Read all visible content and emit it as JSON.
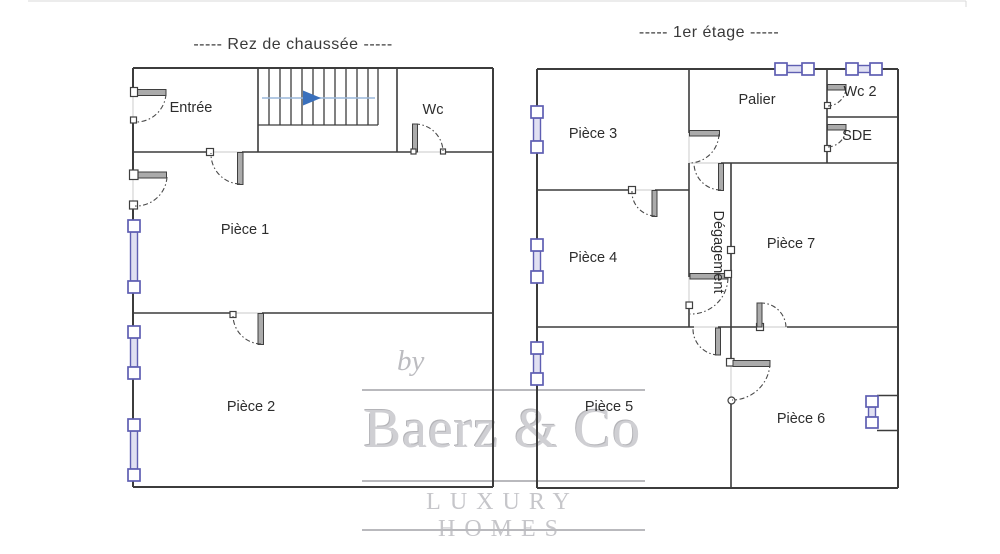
{
  "ground_floor": {
    "title": "-----  Rez de chaussée  -----",
    "rooms": {
      "entree": {
        "label": "Entrée"
      },
      "wc": {
        "label": "Wc"
      },
      "piece1": {
        "label": "Pièce 1"
      },
      "piece2": {
        "label": "Pièce 2"
      }
    }
  },
  "first_floor": {
    "title": "-----  1er étage  -----",
    "rooms": {
      "piece3": {
        "label": "Pièce 3"
      },
      "palier": {
        "label": "Palier"
      },
      "wc2": {
        "label": "Wc 2"
      },
      "sde": {
        "label": "SDE"
      },
      "piece4": {
        "label": "Pièce 4"
      },
      "degagement": {
        "label": "Dégagement"
      },
      "piece7": {
        "label": "Pièce 7"
      },
      "piece5": {
        "label": "Pièce 5"
      },
      "piece6": {
        "label": "Pièce 6"
      }
    }
  },
  "watermark": {
    "prefix": "by",
    "brand": "Baerz & Co",
    "tagline": "LUXURY HOMES"
  },
  "colors": {
    "wall": "#3c3c3c",
    "door_leaf": "#ababab",
    "window_frame": "#5f5fb2",
    "window_glass": "#e0e0f2",
    "arrow": "#3a70bc",
    "arrow_line": "#9ab7da",
    "watermark": "#c9c9cc",
    "text": "#2d2d2d",
    "title": "#3a3a3a",
    "faint": "#d4d4d4"
  }
}
